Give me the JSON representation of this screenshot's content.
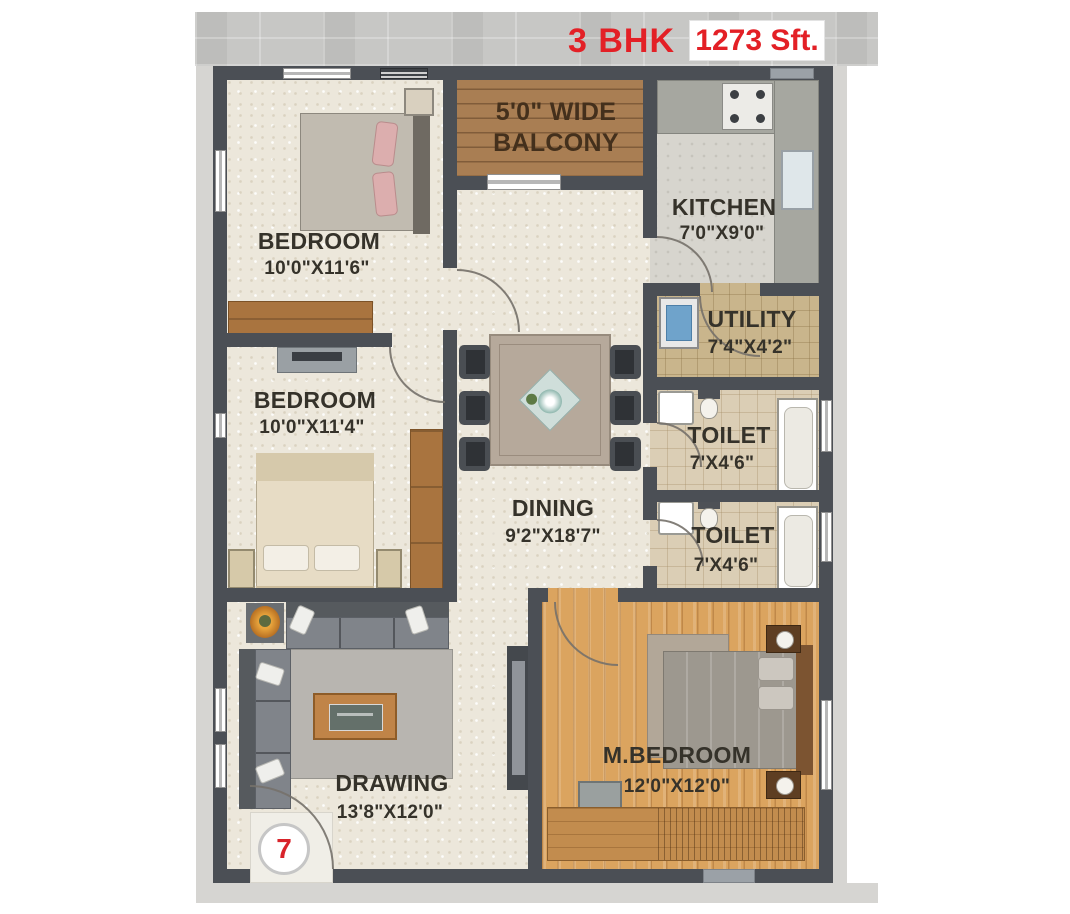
{
  "header": {
    "type_label": "3 BHK",
    "area_label": "1273 Sft."
  },
  "unit": {
    "number": "7"
  },
  "rooms": {
    "bedroom1": {
      "name": "BEDROOM",
      "dims": "10'0\"X11'6\""
    },
    "balcony": {
      "name_line1": "5'0\" WIDE",
      "name_line2": "BALCONY"
    },
    "kitchen": {
      "name": "KITCHEN",
      "dims": "7'0\"X9'0\""
    },
    "utility": {
      "name": "UTILITY",
      "dims": "7'4\"X4'2\""
    },
    "toilet1": {
      "name": "TOILET",
      "dims": "7'X4'6\""
    },
    "toilet2": {
      "name": "TOILET",
      "dims": "7'X4'6\""
    },
    "dining": {
      "name": "DINING",
      "dims": "9'2\"X18'7\""
    },
    "bedroom2": {
      "name": "BEDROOM",
      "dims": "10'0\"X11'4\""
    },
    "drawing": {
      "name": "DRAWING",
      "dims": "13'8\"X12'0\""
    },
    "mbedroom": {
      "name": "M.BEDROOM",
      "dims": "12'0\"X12'0\""
    }
  },
  "colors": {
    "accent_red": "#e32026",
    "wall": "#4b4f55",
    "floor_cream": "#ece7db",
    "wood_balcony": "#a97e53",
    "wood_master": "#dba45f"
  }
}
